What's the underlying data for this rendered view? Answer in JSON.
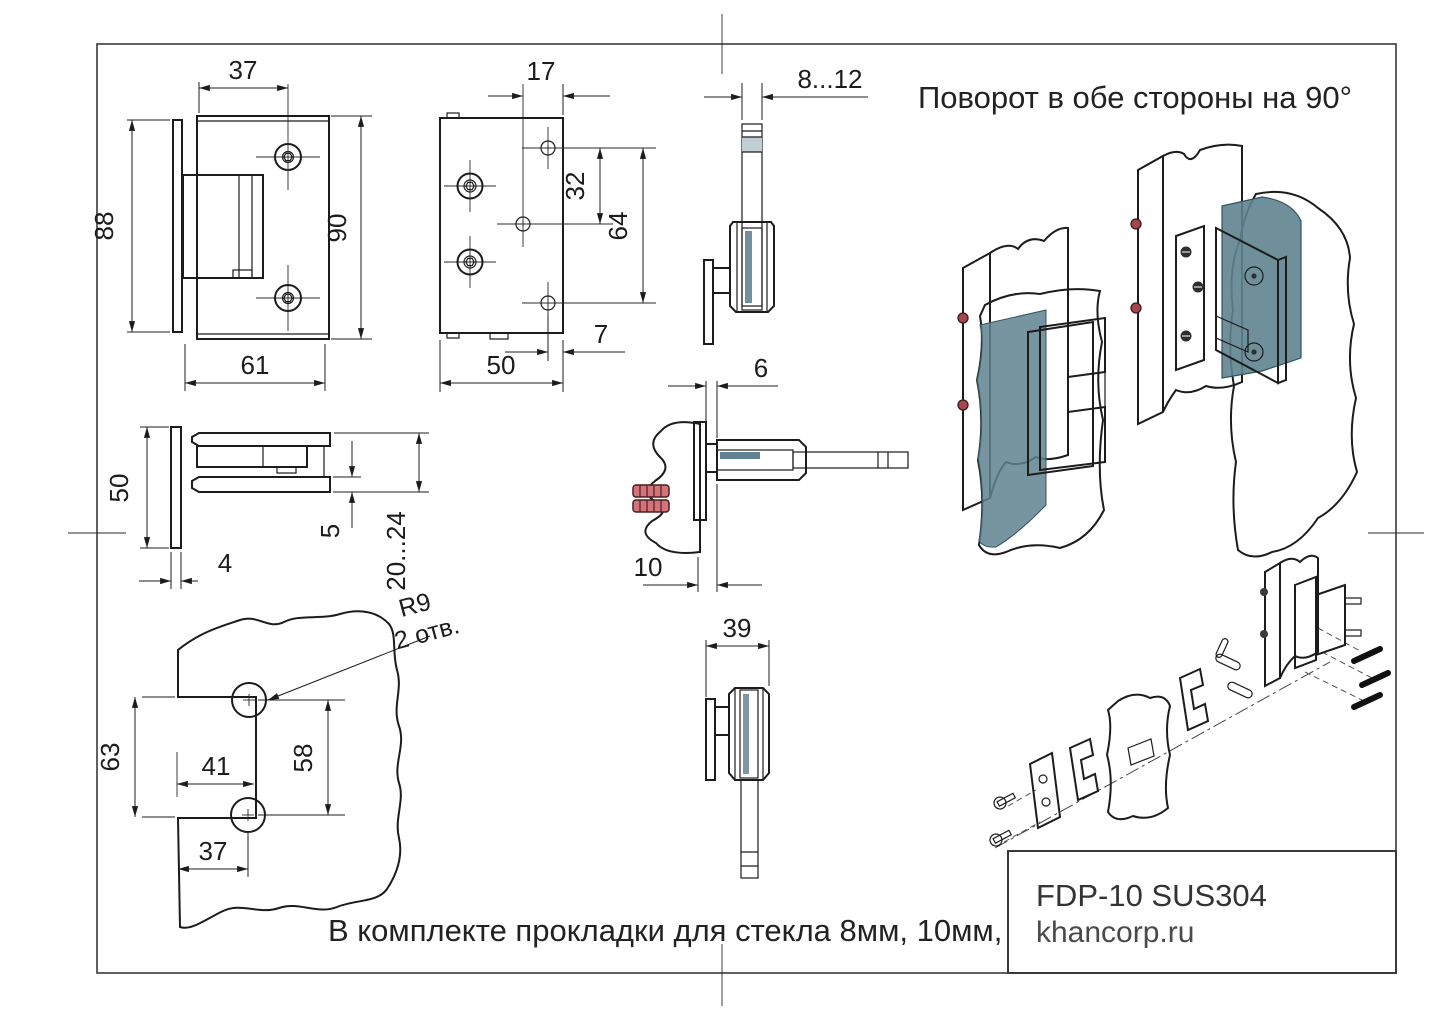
{
  "drawing": {
    "notes": {
      "rotation": "Поворот в обе стороны на 90°",
      "gaskets": "В комплекте прокладки для стекла 8мм, 10мм, 12мм"
    },
    "title_block": {
      "model": "FDP-10 SUS304",
      "website": "khancorp.ru"
    },
    "views": {
      "front": {
        "dim_top": "37",
        "dim_left": "88",
        "dim_right": "90",
        "dim_bottom": "61"
      },
      "back": {
        "dim_top": "17",
        "dim_inner": "32",
        "dim_outer": "64",
        "dim_edge": "7",
        "dim_width": "50"
      },
      "glass_edge": {
        "dim_thickness": "8...12"
      },
      "plan": {
        "dim_height": "50",
        "dim_plate": "4",
        "dim_lip": "5",
        "dim_range": "20...24"
      },
      "wall_section": {
        "dim_gap": "6",
        "dim_offset": "10"
      },
      "side": {
        "dim_width": "39"
      },
      "template": {
        "label_radius": "R9",
        "label_holes": "2 отв.",
        "dim_notch_height": "63",
        "dim_notch_width": "41",
        "dim_hole_centers": "58",
        "dim_hole_x": "37"
      }
    },
    "colors": {
      "glass_light": "#cfdbe1",
      "glass_dark": "#5d7f8e",
      "wall": "#c2b89f",
      "metal": "#b9bdbb",
      "hinge_metal": "#b6ad9c",
      "anchor_red": "#d4737a"
    }
  }
}
